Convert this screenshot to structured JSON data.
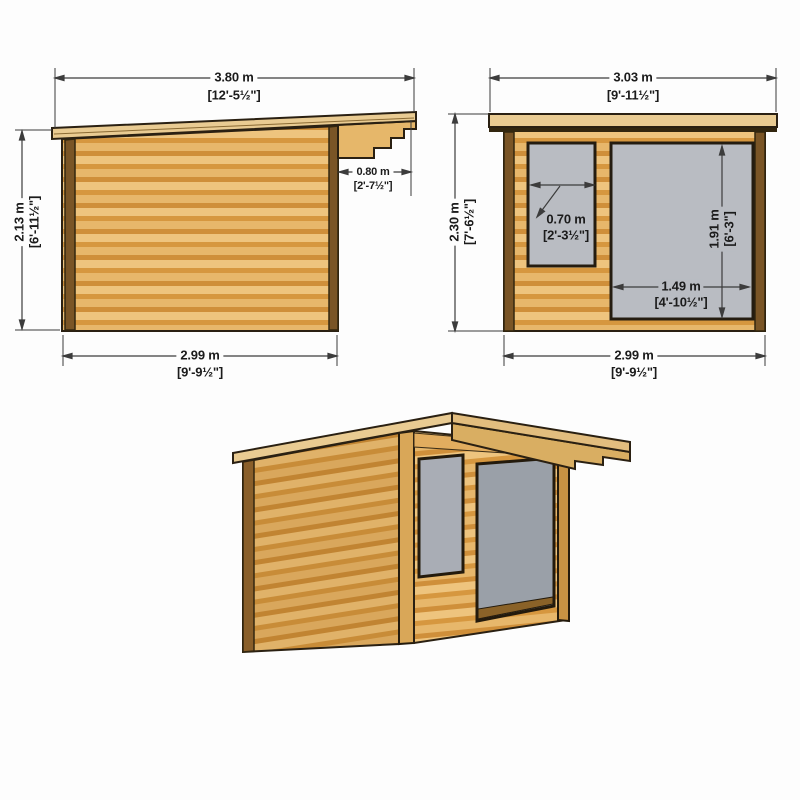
{
  "diagram": {
    "title": "log-cabin-dimension-drawing",
    "colors": {
      "background": "#fdfdfd",
      "wood_light": "#eec47e",
      "wood_dark": "#d6973f",
      "roof_wood": "#e9cb92",
      "trim_brown": "#7a5526",
      "outline": "#2a2012",
      "glass_grey": "#b9bcc2",
      "dim_lines": "#3c3c3c"
    },
    "views": {
      "side": {
        "label": "side-elevation",
        "dims": {
          "width": {
            "m": "3.80 m",
            "i": "[12'-5½\"]"
          },
          "height": {
            "m": "2.13 m",
            "i": "[6'-11½\"]"
          },
          "overhang": {
            "m": "0.80 m",
            "i": "[2'-7½\"]"
          },
          "base": {
            "m": "2.99 m",
            "i": "[9'-9½\"]"
          }
        }
      },
      "front": {
        "label": "front-elevation",
        "dims": {
          "width": {
            "m": "3.03 m",
            "i": "[9'-11½\"]"
          },
          "height": {
            "m": "2.30 m",
            "i": "[7'-6½\"]"
          },
          "window": {
            "m": "0.70 m",
            "i": "[2'-3½\"]"
          },
          "door_h": {
            "m": "1.91 m",
            "i": "[6'-3\"]"
          },
          "door_w": {
            "m": "1.49 m",
            "i": "[4'-10½\"]"
          },
          "base": {
            "m": "2.99 m",
            "i": "[9'-9½\"]"
          }
        }
      },
      "perspective": {
        "label": "3d-perspective-view"
      }
    }
  }
}
